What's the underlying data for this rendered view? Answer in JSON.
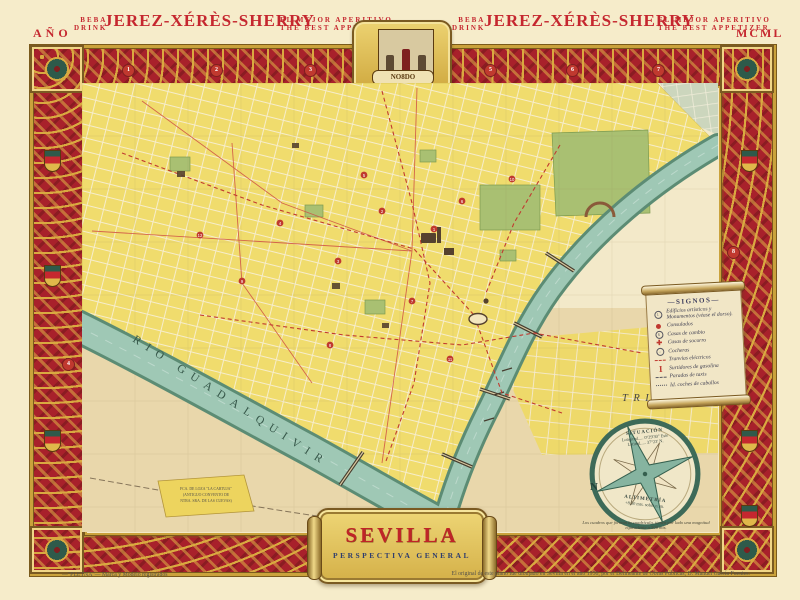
{
  "header": {
    "year_label": "AÑO",
    "year_roman": "MCML",
    "ads": [
      {
        "beba": "BEBA",
        "drink": "DRINK",
        "title": "JEREZ-XÉRÈS-SHERRY",
        "tag1": "EL MEJOR APERITIVO",
        "tag2": "THE BEST APPETIZER"
      },
      {
        "beba": "BEBA",
        "drink": "DRINK",
        "title": "JEREZ-XÉRÈS-SHERRY",
        "tag1": "EL MEJOR APERITIVO",
        "tag2": "THE BEST APPETIZER"
      }
    ]
  },
  "crest": {
    "motto": "NO8DO"
  },
  "map": {
    "river_label": "RIO GUADALQUIVIR",
    "district_label": "TRIANA",
    "factory_lines": [
      "FCA. DE LOZA \"LA CARTUJA\"",
      "(ANTIGUO CONVENTO DE",
      "NTRA. SRA. DE LAS CUEVAS)"
    ],
    "section_markers": [
      "1",
      "2",
      "3",
      "4",
      "5",
      "6",
      "7",
      "8"
    ],
    "monuments": [
      "1",
      "2",
      "3",
      "4",
      "5",
      "6",
      "7",
      "8",
      "9",
      "10",
      "11",
      "12"
    ]
  },
  "legend": {
    "title": "—SIGNOS—",
    "items": [
      {
        "icon": "monument-circle-icon",
        "label": "Edificios artísticos y Monumentos (véase el dorso)."
      },
      {
        "icon": "red-dot-icon",
        "label": "Consulados"
      },
      {
        "icon": "exchange-icon",
        "label": "Casas de cambio"
      },
      {
        "icon": "red-cross-icon",
        "label": "Casas de socorro"
      },
      {
        "icon": "depot-circle-icon",
        "label": "Cocheras"
      },
      {
        "icon": "tram-line-icon",
        "label": "Tranvías eléctricos"
      },
      {
        "icon": "petrol-pump-icon",
        "label": "Surtidores de gasolina"
      },
      {
        "icon": "taxi-stop-line-icon",
        "label": "Paradas de taxis"
      },
      {
        "icon": "carriage-stop-line-icon",
        "label": "Id. coches de caballos"
      }
    ]
  },
  "compass": {
    "north_label": "N",
    "situation_title": "SITUACIÓN",
    "longitude": "Longitud..... 0°29'30\" Este",
    "latitude": "Latitud..... 37°23' N.",
    "altimetry_title": "ALTIMETRÍA",
    "altimetry_value": "+8,50 mts. sobre n. m.",
    "note": "Los cuadros que forman la cuadrícula, tienen por lado una magnitud equivalente a 500 mts."
  },
  "cartouche": {
    "title": "SEVILLA",
    "subtitle": "PERSPECTIVA GENERAL"
  },
  "footer": {
    "left": "—\"PLETNA\"— Marca y Modelo registrados",
    "right": "El original de este plano fue dibujado en Sevilla en el año 1950, por el Delineante de Obras Públicas, D. Manuel García Fuentes."
  },
  "colors": {
    "page_cream": "#f6ecca",
    "border_red": "#a8212b",
    "border_gold": "#d4a13c",
    "map_yellow": "#f0dc6d",
    "river_teal": "#9fc8b5",
    "park_green": "#a9c072",
    "accent_red": "#c5272f",
    "navy_text": "#2e3d6e"
  }
}
